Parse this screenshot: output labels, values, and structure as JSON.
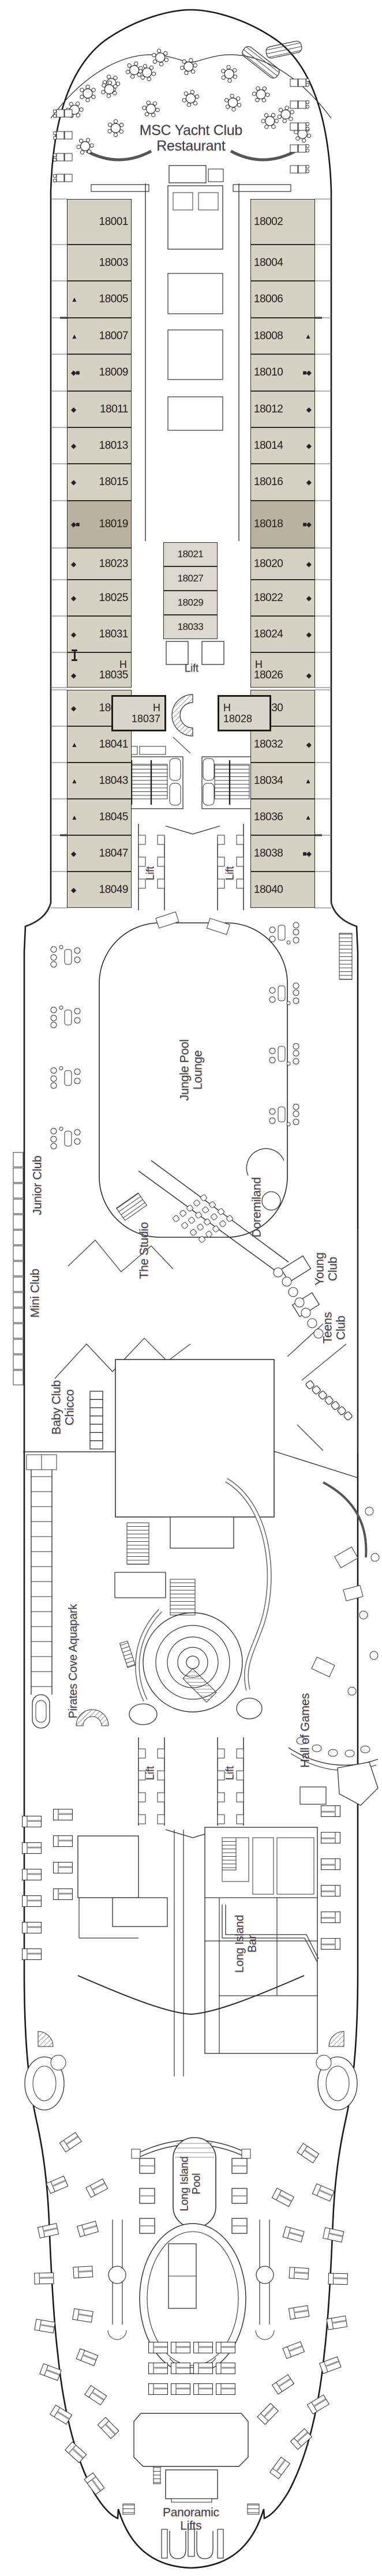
{
  "deck_plan": {
    "restaurant_title": "MSC Yacht Club\nRestaurant",
    "venues": {
      "jungle_pool_lounge": "Jungle Pool\nLounge",
      "junior_club": "Junior Club",
      "mini_club": "Mini Club",
      "baby_club_chicco": "Baby Club\nChicco",
      "the_studio": "The Studio",
      "doremiland": "Doremiland",
      "young_club": "Young Club",
      "teens_club": "Teens\nClub",
      "pirates_cove_aquapark": "Pirates Cove Aquapark",
      "hall_of_games": "Hall of Games",
      "long_island_bar": "Long Island\nBar",
      "long_island_pool": "Long Island\nPool",
      "panoramic_lifts": "Panoramic\nLifts"
    },
    "lift_label": "Lift",
    "symbol_glyphs": {
      "diamond": "◆",
      "square": "■",
      "triangle": "▲"
    },
    "cabins": {
      "forward_left": [
        {
          "n": "18001",
          "s": []
        },
        {
          "n": "18003",
          "s": []
        },
        {
          "n": "18005",
          "s": [
            "triangle"
          ]
        },
        {
          "n": "18007",
          "s": [
            "triangle"
          ]
        },
        {
          "n": "18009",
          "s": [
            "diamond",
            "square"
          ]
        },
        {
          "n": "18011",
          "s": [
            "diamond"
          ]
        },
        {
          "n": "18013",
          "s": [
            "diamond"
          ]
        },
        {
          "n": "18015",
          "s": [
            "diamond"
          ]
        },
        {
          "n": "18019",
          "s": [
            "diamond",
            "square"
          ],
          "dark": true
        },
        {
          "n": "18023",
          "s": [
            "diamond"
          ]
        },
        {
          "n": "18025",
          "s": [
            "diamond"
          ]
        },
        {
          "n": "18031",
          "s": [
            "diamond"
          ]
        },
        {
          "n": "18035",
          "s": [
            "diamond"
          ],
          "h": "H"
        }
      ],
      "forward_right": [
        {
          "n": "18002",
          "s": []
        },
        {
          "n": "18004",
          "s": []
        },
        {
          "n": "18006",
          "s": []
        },
        {
          "n": "18008",
          "s": [
            "triangle"
          ]
        },
        {
          "n": "18010",
          "s": [
            "square",
            "diamond"
          ]
        },
        {
          "n": "18012",
          "s": [
            "diamond"
          ]
        },
        {
          "n": "18014",
          "s": [
            "diamond"
          ]
        },
        {
          "n": "18016",
          "s": [
            "diamond"
          ]
        },
        {
          "n": "18018",
          "s": [
            "square",
            "diamond"
          ],
          "dark": true
        },
        {
          "n": "18020",
          "s": [
            "diamond"
          ]
        },
        {
          "n": "18022",
          "s": [
            "diamond"
          ]
        },
        {
          "n": "18024",
          "s": [
            "diamond"
          ]
        },
        {
          "n": "18026",
          "s": [
            "diamond"
          ],
          "h": "H"
        }
      ],
      "forward_inside": [
        {
          "n": "18021"
        },
        {
          "n": "18027"
        },
        {
          "n": "18029"
        },
        {
          "n": "18033"
        }
      ],
      "handicap_inside": [
        {
          "n": "18037",
          "h": "H"
        },
        {
          "n": "18028",
          "h": "H"
        }
      ],
      "mid_left": [
        {
          "n": "18039",
          "s": [
            "diamond"
          ]
        },
        {
          "n": "18041",
          "s": [
            "triangle"
          ]
        },
        {
          "n": "18043",
          "s": [
            "triangle"
          ]
        },
        {
          "n": "18045",
          "s": [
            "triangle"
          ]
        },
        {
          "n": "18047",
          "s": [
            "diamond"
          ]
        },
        {
          "n": "18049",
          "s": [
            "diamond"
          ]
        }
      ],
      "mid_right": [
        {
          "n": "18030",
          "s": []
        },
        {
          "n": "18032",
          "s": [
            "diamond"
          ]
        },
        {
          "n": "18034",
          "s": [
            "triangle"
          ]
        },
        {
          "n": "18036",
          "s": [
            "triangle"
          ]
        },
        {
          "n": "18038",
          "s": [
            "square",
            "diamond"
          ]
        },
        {
          "n": "18040",
          "s": []
        }
      ]
    },
    "colors": {
      "cabin": "#d5d2c3",
      "cabin_dark": "#b9b2a1",
      "cabin_inside": "#dbd9cf",
      "label_text": "#35415f",
      "number_text": "#23232e",
      "wall": "#2f2d28"
    }
  }
}
